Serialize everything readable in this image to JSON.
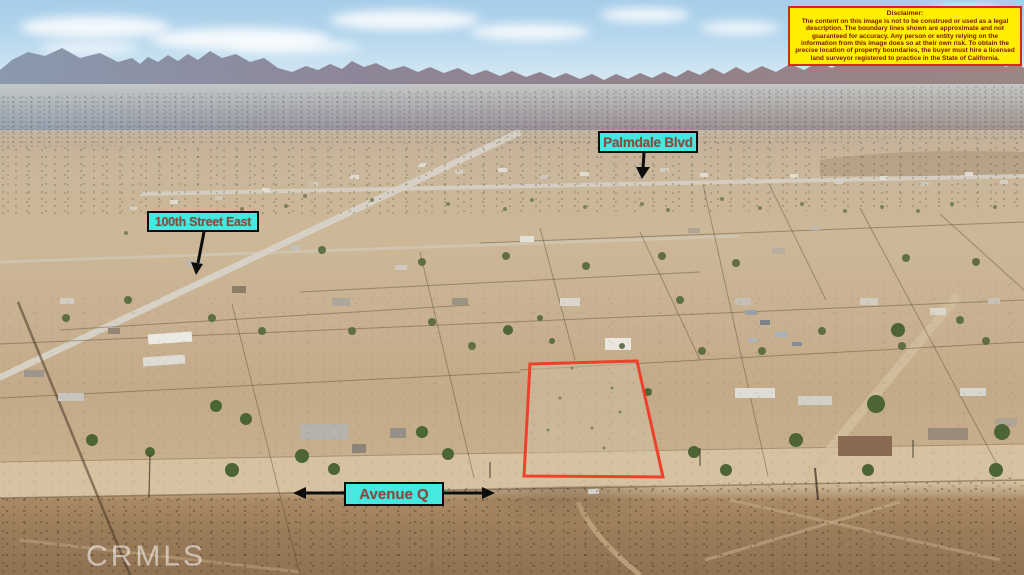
{
  "disclaimer": {
    "title": "Disclaimer:",
    "body": "The content on this image is not to be construed or used as a legal description. The boundary lines shown are approximate and not guaranteed for accuracy. Any person or entity relying on the information from this image does so at their own risk. To obtain the precise location of property boundaries, the buyer must hire a licensed land surveyor registered to practice in the State of California."
  },
  "street_labels": {
    "palmdale_blvd": "Palmdale Blvd",
    "street_100th": "100th Street East",
    "avenue_q": "Avenue Q"
  },
  "watermark": {
    "text": "CRMLS"
  },
  "colors": {
    "label_bg": "#45e9e2",
    "label_text": "#8b4a3e",
    "label_border": "#0d0d0d",
    "boundary_red": "#f03a26",
    "disclaimer_bg": "#ffee00",
    "disclaimer_border": "#d42a1e",
    "disclaimer_text": "#7a1505",
    "arrow_black": "#0d0d0d",
    "watermark_white": "rgba(255,255,255,0.55)"
  }
}
